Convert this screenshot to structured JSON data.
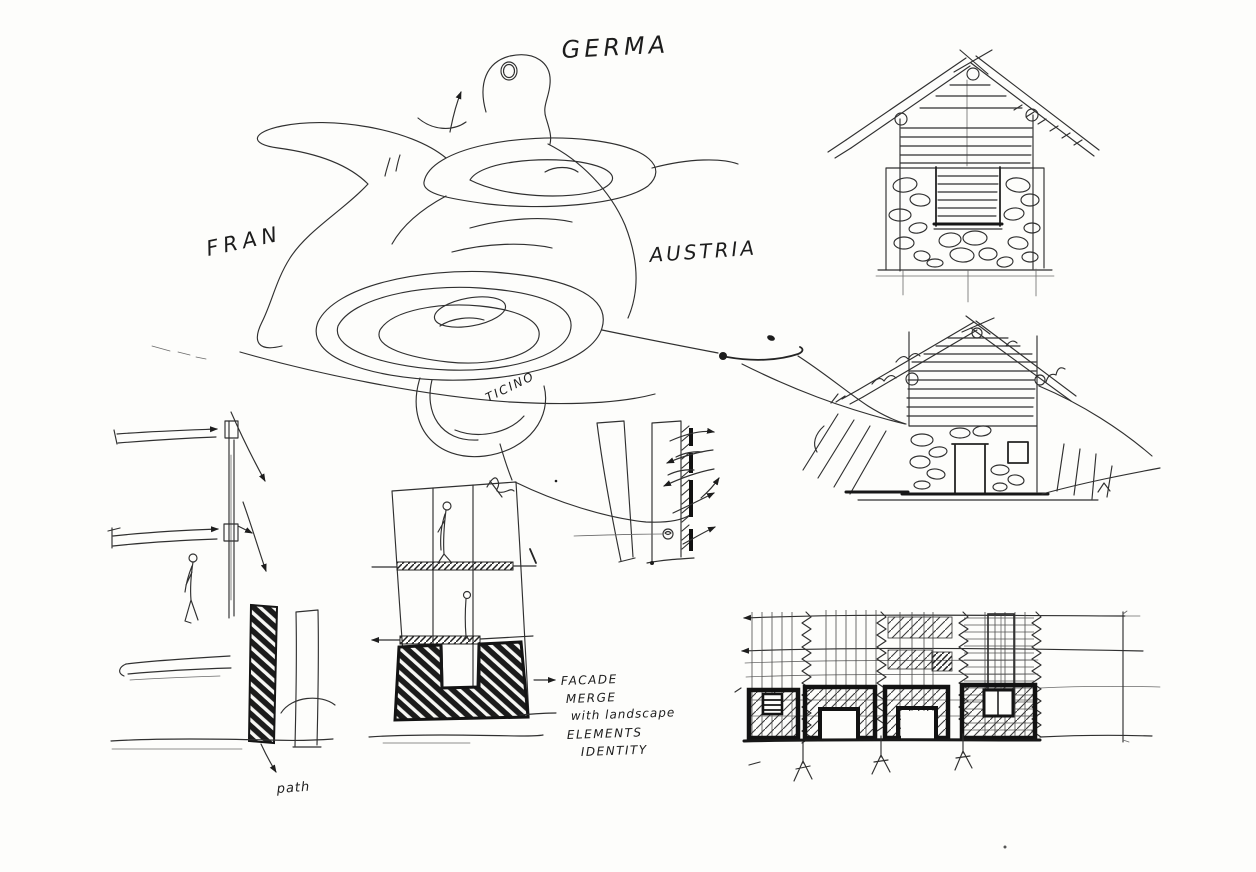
{
  "palette": {
    "paper": "#fdfdfb",
    "ink": "#222222"
  },
  "map": {
    "germany": "GERMA",
    "france": "FRAN",
    "austria": "AUSTRIA",
    "ticino": "TICINO"
  },
  "left_section": {
    "path_label": "path"
  },
  "annotation": {
    "line1": "FACADE",
    "line2": "MERGE",
    "line3": "with landscape",
    "line4": "ELEMENTS",
    "line5": "IDENTITY"
  }
}
